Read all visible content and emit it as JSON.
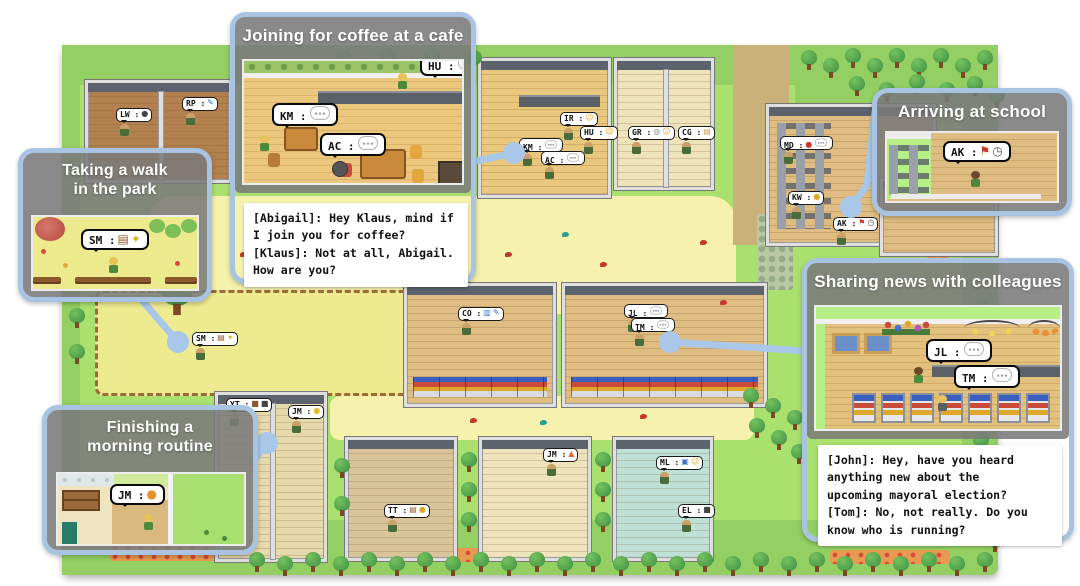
{
  "colors": {
    "callout_border": "#a9c4e2",
    "connector": "#a9c7e8",
    "panel_gray": "#7a7a7a",
    "dialogue_bg": "#ffffff",
    "map_grass": "#a9e06e",
    "map_plaza": "#f6f2ae"
  },
  "callouts": {
    "walk": {
      "title": "Taking a walk\nin the park",
      "bubble_label": "SM :",
      "bubble_icons": [
        "book",
        "sparkle"
      ]
    },
    "coffee": {
      "title": "Joining for coffee at a cafe",
      "km_label": "KM :",
      "ac_label": "AC :",
      "hu_label": "HU :",
      "bubble_icons": [
        "chat"
      ],
      "dialogue": "[Abigail]: Hey Klaus, mind if\nI join you for coffee?\n[Klaus]: Not at all, Abigail.\nHow are you?"
    },
    "school": {
      "title": "Arriving at school",
      "bubble_label": "AK :",
      "bubble_icons": [
        "flag",
        "clock"
      ]
    },
    "news": {
      "title": "Sharing news with colleagues",
      "jl_label": "JL :",
      "tm_label": "TM :",
      "bubble_icons": [
        "chat"
      ],
      "dialogue": "[John]: Hey, have you heard\nanything new about the\nupcoming mayoral election?\n[Tom]: No, not really. Do you\nknow who is running?"
    },
    "morning": {
      "title": "Finishing a\nmorning routine",
      "bubble_label": "JM :",
      "bubble_icons": [
        "cat"
      ]
    }
  },
  "map": {
    "areas": [
      {
        "x": 62,
        "y": 45,
        "w": 936,
        "h": 530,
        "color": "#a9e06e",
        "r": 8,
        "cls": "mapbase",
        "name": "map-base"
      },
      {
        "x": 62,
        "y": 45,
        "w": 936,
        "h": 40,
        "color": "#93cf63",
        "r": 8,
        "name": "dark-grass"
      },
      {
        "x": 795,
        "y": 45,
        "w": 203,
        "h": 78,
        "color": "#93cf63",
        "name": "dark-grass"
      },
      {
        "x": 62,
        "y": 520,
        "w": 936,
        "h": 55,
        "color": "#93cf63",
        "r": 8,
        "name": "dark-grass"
      },
      {
        "x": 62,
        "y": 45,
        "w": 18,
        "h": 530,
        "color": "#93cf63",
        "name": "dark-grass"
      },
      {
        "x": 962,
        "y": 110,
        "w": 36,
        "h": 440,
        "color": "#93cf63",
        "name": "dark-grass"
      },
      {
        "x": 148,
        "y": 196,
        "w": 588,
        "h": 118,
        "color": "#f6f2ae",
        "r": 26,
        "name": "plaza"
      },
      {
        "x": 330,
        "y": 396,
        "w": 424,
        "h": 44,
        "color": "#f6f2ae",
        "r": 10,
        "name": "path"
      },
      {
        "x": 95,
        "y": 290,
        "w": 330,
        "h": 106,
        "color": "#eeea8f",
        "r": 8,
        "cls": "park",
        "name": "park"
      },
      {
        "x": 733,
        "y": 45,
        "w": 56,
        "h": 200,
        "color": "#c9b179",
        "name": "dirt-road"
      }
    ],
    "flowerbeds": [
      {
        "x": 110,
        "y": 543,
        "w": 112,
        "h": 18
      },
      {
        "x": 372,
        "y": 548,
        "w": 172,
        "h": 14
      },
      {
        "x": 830,
        "y": 550,
        "w": 120,
        "h": 14
      },
      {
        "x": 925,
        "y": 214,
        "w": 26,
        "h": 44
      }
    ],
    "hedges": [
      {
        "x": 757,
        "y": 214,
        "w": 36,
        "h": 76
      }
    ],
    "buildings": [
      {
        "x": 85,
        "y": 80,
        "w": 147,
        "h": 103,
        "f": "#b3804f",
        "kind": "house2"
      },
      {
        "x": 478,
        "y": 58,
        "w": 133,
        "h": 140,
        "f": "#e9c77d",
        "kind": "cafe"
      },
      {
        "x": 614,
        "y": 58,
        "w": 100,
        "h": 132,
        "f": "#efe3bb",
        "kind": "house2"
      },
      {
        "x": 766,
        "y": 104,
        "w": 170,
        "h": 142,
        "f": "#dfbd82",
        "kind": "school"
      },
      {
        "x": 880,
        "y": 178,
        "w": 118,
        "h": 78,
        "f": "#dfbd82",
        "kind": "house"
      },
      {
        "x": 404,
        "y": 283,
        "w": 152,
        "h": 124,
        "f": "#dfbd82",
        "kind": "store"
      },
      {
        "x": 562,
        "y": 283,
        "w": 205,
        "h": 124,
        "f": "#dfbd82",
        "kind": "store"
      },
      {
        "x": 215,
        "y": 392,
        "w": 112,
        "h": 170,
        "f": "#e6d9ab",
        "kind": "house2"
      },
      {
        "x": 345,
        "y": 437,
        "w": 112,
        "h": 124,
        "f": "#d9c49a",
        "kind": "house"
      },
      {
        "x": 479,
        "y": 437,
        "w": 112,
        "h": 124,
        "f": "#efe3bb",
        "kind": "house"
      },
      {
        "x": 613,
        "y": 437,
        "w": 100,
        "h": 124,
        "f": "#bfe0d6",
        "kind": "house"
      }
    ],
    "bubbles": [
      {
        "l": "LW :",
        "icons": [
          "pan"
        ],
        "x": 116,
        "y": 108
      },
      {
        "l": "RP :",
        "icons": [
          "pen"
        ],
        "x": 182,
        "y": 97
      },
      {
        "l": "IR :",
        "icons": [
          "smiley"
        ],
        "x": 560,
        "y": 112
      },
      {
        "l": "HU :",
        "icons": [
          "smiley"
        ],
        "x": 580,
        "y": 126
      },
      {
        "l": "KM :",
        "icons": [
          "chat"
        ],
        "x": 519,
        "y": 138
      },
      {
        "l": "AC :",
        "icons": [
          "chat"
        ],
        "x": 541,
        "y": 151
      },
      {
        "l": "GR :",
        "icons": [
          "dish",
          "smiley"
        ],
        "x": 628,
        "y": 126
      },
      {
        "l": "CG :",
        "icons": [
          "note"
        ],
        "x": 678,
        "y": 126
      },
      {
        "l": "MD :",
        "icons": [
          "apple",
          "chat"
        ],
        "x": 780,
        "y": 136
      },
      {
        "l": "KW :",
        "icons": [
          "coin"
        ],
        "x": 788,
        "y": 191
      },
      {
        "l": "AK :",
        "icons": [
          "flag",
          "clock"
        ],
        "x": 833,
        "y": 217
      },
      {
        "l": "SM :",
        "icons": [
          "book",
          "sparkle"
        ],
        "x": 192,
        "y": 332
      },
      {
        "l": "CO :",
        "icons": [
          "chart",
          "pen"
        ],
        "x": 458,
        "y": 307
      },
      {
        "l": "JL :",
        "icons": [
          "chat"
        ],
        "x": 624,
        "y": 304
      },
      {
        "l": "TM :",
        "icons": [
          "chat"
        ],
        "x": 631,
        "y": 318
      },
      {
        "l": "YT :",
        "icons": [
          "bag",
          "dark"
        ],
        "x": 226,
        "y": 398
      },
      {
        "l": "JM :",
        "icons": [
          "bell"
        ],
        "x": 288,
        "y": 405
      },
      {
        "l": "TT :",
        "icons": [
          "book",
          "coin"
        ],
        "x": 384,
        "y": 504
      },
      {
        "l": "JM :",
        "icons": [
          "fire"
        ],
        "x": 543,
        "y": 448
      },
      {
        "l": "ML :",
        "icons": [
          "shield",
          "smiley"
        ],
        "x": 656,
        "y": 456
      },
      {
        "l": "EL :",
        "icons": [
          "dark"
        ],
        "x": 678,
        "y": 504
      }
    ],
    "trees": [
      [
        800,
        50
      ],
      [
        822,
        58
      ],
      [
        844,
        48
      ],
      [
        866,
        58
      ],
      [
        888,
        48
      ],
      [
        910,
        58
      ],
      [
        932,
        48
      ],
      [
        954,
        58
      ],
      [
        976,
        50
      ],
      [
        848,
        76
      ],
      [
        878,
        82
      ],
      [
        908,
        74
      ],
      [
        938,
        82
      ],
      [
        966,
        76
      ],
      [
        988,
        88
      ],
      [
        335,
        50
      ],
      [
        357,
        58
      ],
      [
        379,
        48
      ],
      [
        401,
        56
      ],
      [
        423,
        48
      ],
      [
        445,
        56
      ],
      [
        465,
        50
      ],
      [
        975,
        130
      ],
      [
        985,
        162
      ],
      [
        973,
        300
      ],
      [
        985,
        332
      ],
      [
        970,
        364
      ],
      [
        985,
        398
      ],
      [
        972,
        432
      ],
      [
        985,
        466
      ],
      [
        970,
        500
      ],
      [
        986,
        532
      ],
      [
        742,
        388
      ],
      [
        764,
        398
      ],
      [
        786,
        410
      ],
      [
        748,
        418
      ],
      [
        770,
        430
      ],
      [
        790,
        444
      ],
      [
        248,
        552
      ],
      [
        276,
        556
      ],
      [
        304,
        552
      ],
      [
        332,
        556
      ],
      [
        360,
        552
      ],
      [
        388,
        556
      ],
      [
        416,
        552
      ],
      [
        444,
        556
      ],
      [
        472,
        552
      ],
      [
        500,
        556
      ],
      [
        528,
        552
      ],
      [
        556,
        556
      ],
      [
        584,
        552
      ],
      [
        612,
        556
      ],
      [
        640,
        552
      ],
      [
        668,
        556
      ],
      [
        696,
        552
      ],
      [
        724,
        556
      ],
      [
        752,
        552
      ],
      [
        780,
        556
      ],
      [
        808,
        552
      ],
      [
        836,
        556
      ],
      [
        864,
        552
      ],
      [
        892,
        556
      ],
      [
        920,
        552
      ],
      [
        948,
        556
      ],
      [
        976,
        552
      ],
      [
        460,
        452
      ],
      [
        460,
        482
      ],
      [
        460,
        512
      ],
      [
        594,
        452
      ],
      [
        594,
        482
      ],
      [
        594,
        512
      ],
      [
        333,
        458
      ],
      [
        333,
        496
      ],
      [
        168,
        296,
        1
      ],
      [
        68,
        308
      ],
      [
        68,
        344
      ]
    ],
    "birds": [
      [
        130,
        238,
        "#c0392b"
      ],
      [
        178,
        262,
        "#2a9d8f"
      ],
      [
        240,
        252,
        "#c0392b"
      ],
      [
        300,
        240,
        "#8a5a2b"
      ],
      [
        420,
        232,
        "#c0392b"
      ],
      [
        505,
        252,
        "#c0392b"
      ],
      [
        562,
        232,
        "#2a9d8f"
      ],
      [
        600,
        262,
        "#c0392b"
      ],
      [
        700,
        240,
        "#c0392b"
      ],
      [
        470,
        418,
        "#c0392b"
      ],
      [
        540,
        420,
        "#2a9d8f"
      ],
      [
        640,
        414,
        "#c0392b"
      ],
      [
        720,
        300,
        "#c0392b"
      ],
      [
        92,
        270,
        "#c0392b"
      ]
    ],
    "connectors": [
      {
        "pts": "140,298 178,342"
      },
      {
        "pts": "472,162 514,153"
      },
      {
        "pts": "875,112 867,185 851,207"
      },
      {
        "pts": "806,351 670,342"
      },
      {
        "pts": "252,463 267,443"
      }
    ]
  }
}
